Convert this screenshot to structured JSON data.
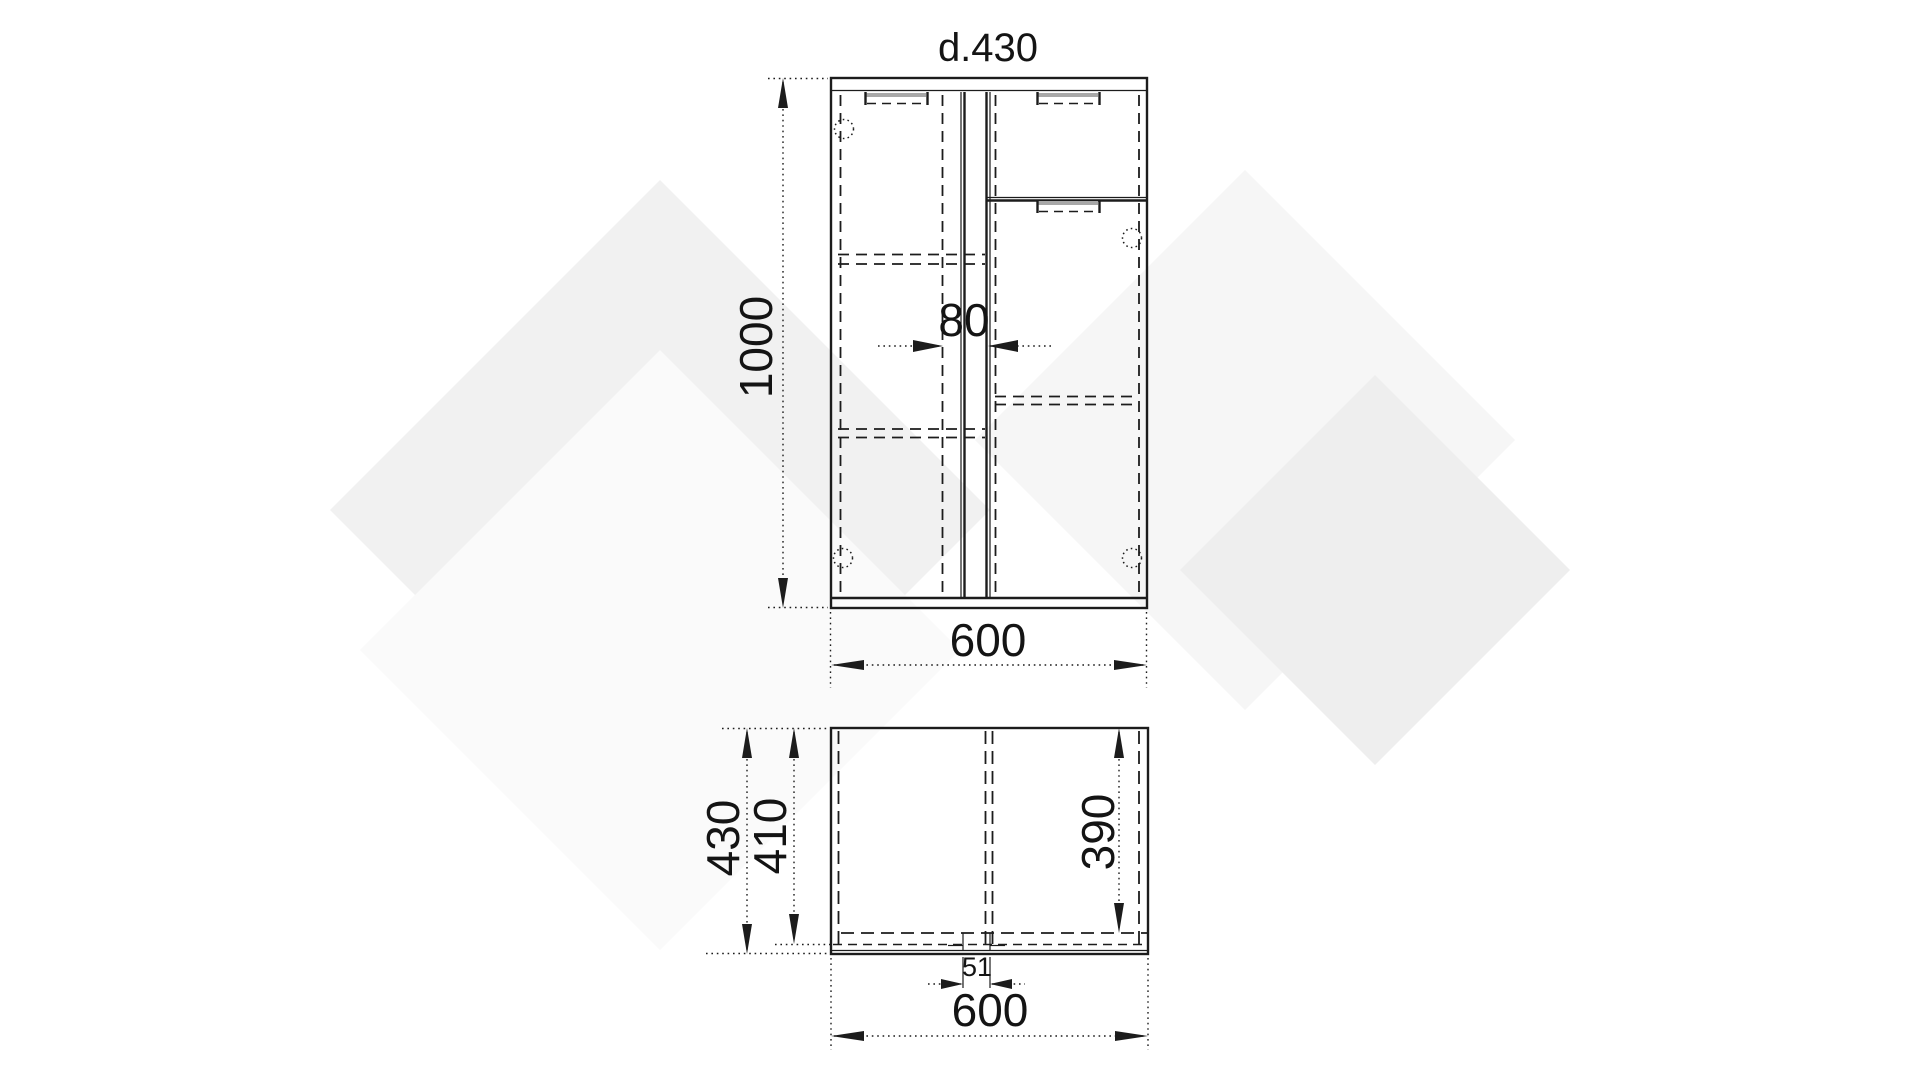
{
  "drawing": {
    "title": "d.430",
    "front_view": {
      "height": "1000",
      "gap": "80",
      "width": "600"
    },
    "plan_view": {
      "depth": "430",
      "inner_depth": "410",
      "interior_depth": "390",
      "groove": "51",
      "width": "600"
    },
    "colors": {
      "line": "#1c1c1c",
      "watermark_light": "#f1f1f1",
      "watermark_dark": "#eeeeee",
      "background": "#ffffff"
    }
  }
}
